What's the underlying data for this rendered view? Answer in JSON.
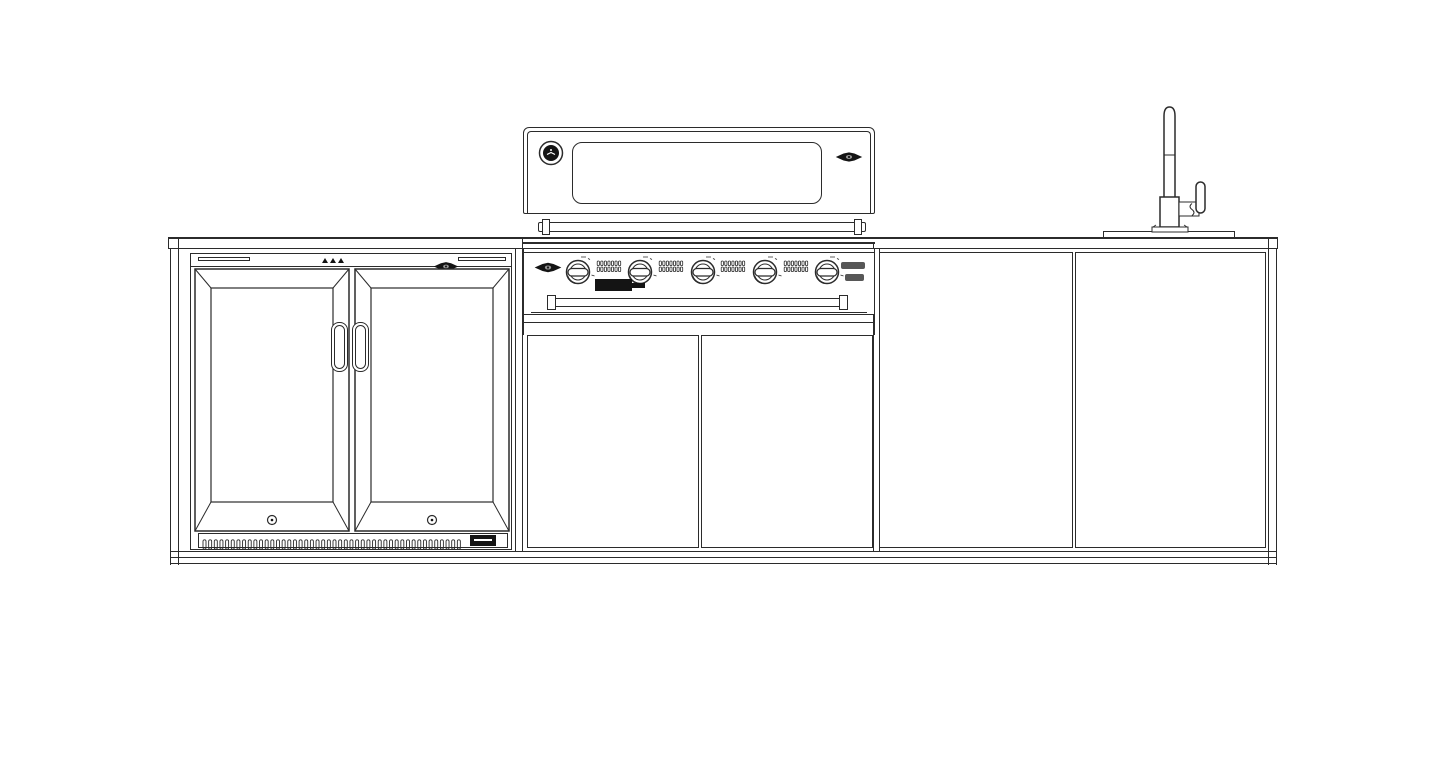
{
  "drawing": {
    "type": "elevation-line-drawing",
    "subject": "outdoor kitchen island with double-door bar fridge, 5-burner built-in BBQ, cabinets and sink",
    "background": "#ffffff",
    "line_color": "#2b2b2b",
    "accent_black": "#141414"
  },
  "fridge": {
    "name": "double-glass-door-bar-fridge",
    "door_count": 2,
    "handle_count": 2,
    "door_screw_count": 2,
    "vent_slot_count": 46,
    "has_diamond_logo": true,
    "has_vent_brand_badge": true
  },
  "grill": {
    "name": "built-in-bbq-with-roasting-hood",
    "burner_knob_count": 5,
    "vent_strip_count": 4,
    "vent_strip_slot_cols": 7,
    "vent_strip_slot_rows": 2,
    "has_temperature_gauge": true,
    "has_hood_window": true,
    "has_diamond_logo_hood": true,
    "has_diamond_logo_fascia": true,
    "has_black_rating_label": true,
    "has_model_badge": true,
    "has_drip_tray_handle": true
  },
  "cabinets": {
    "grill_cart_door_count": 2,
    "right_cabinet_door_count": 2
  },
  "sink": {
    "basin_count": 1,
    "tap_count": 1,
    "tap_style": "gooseneck-with-side-lever"
  }
}
